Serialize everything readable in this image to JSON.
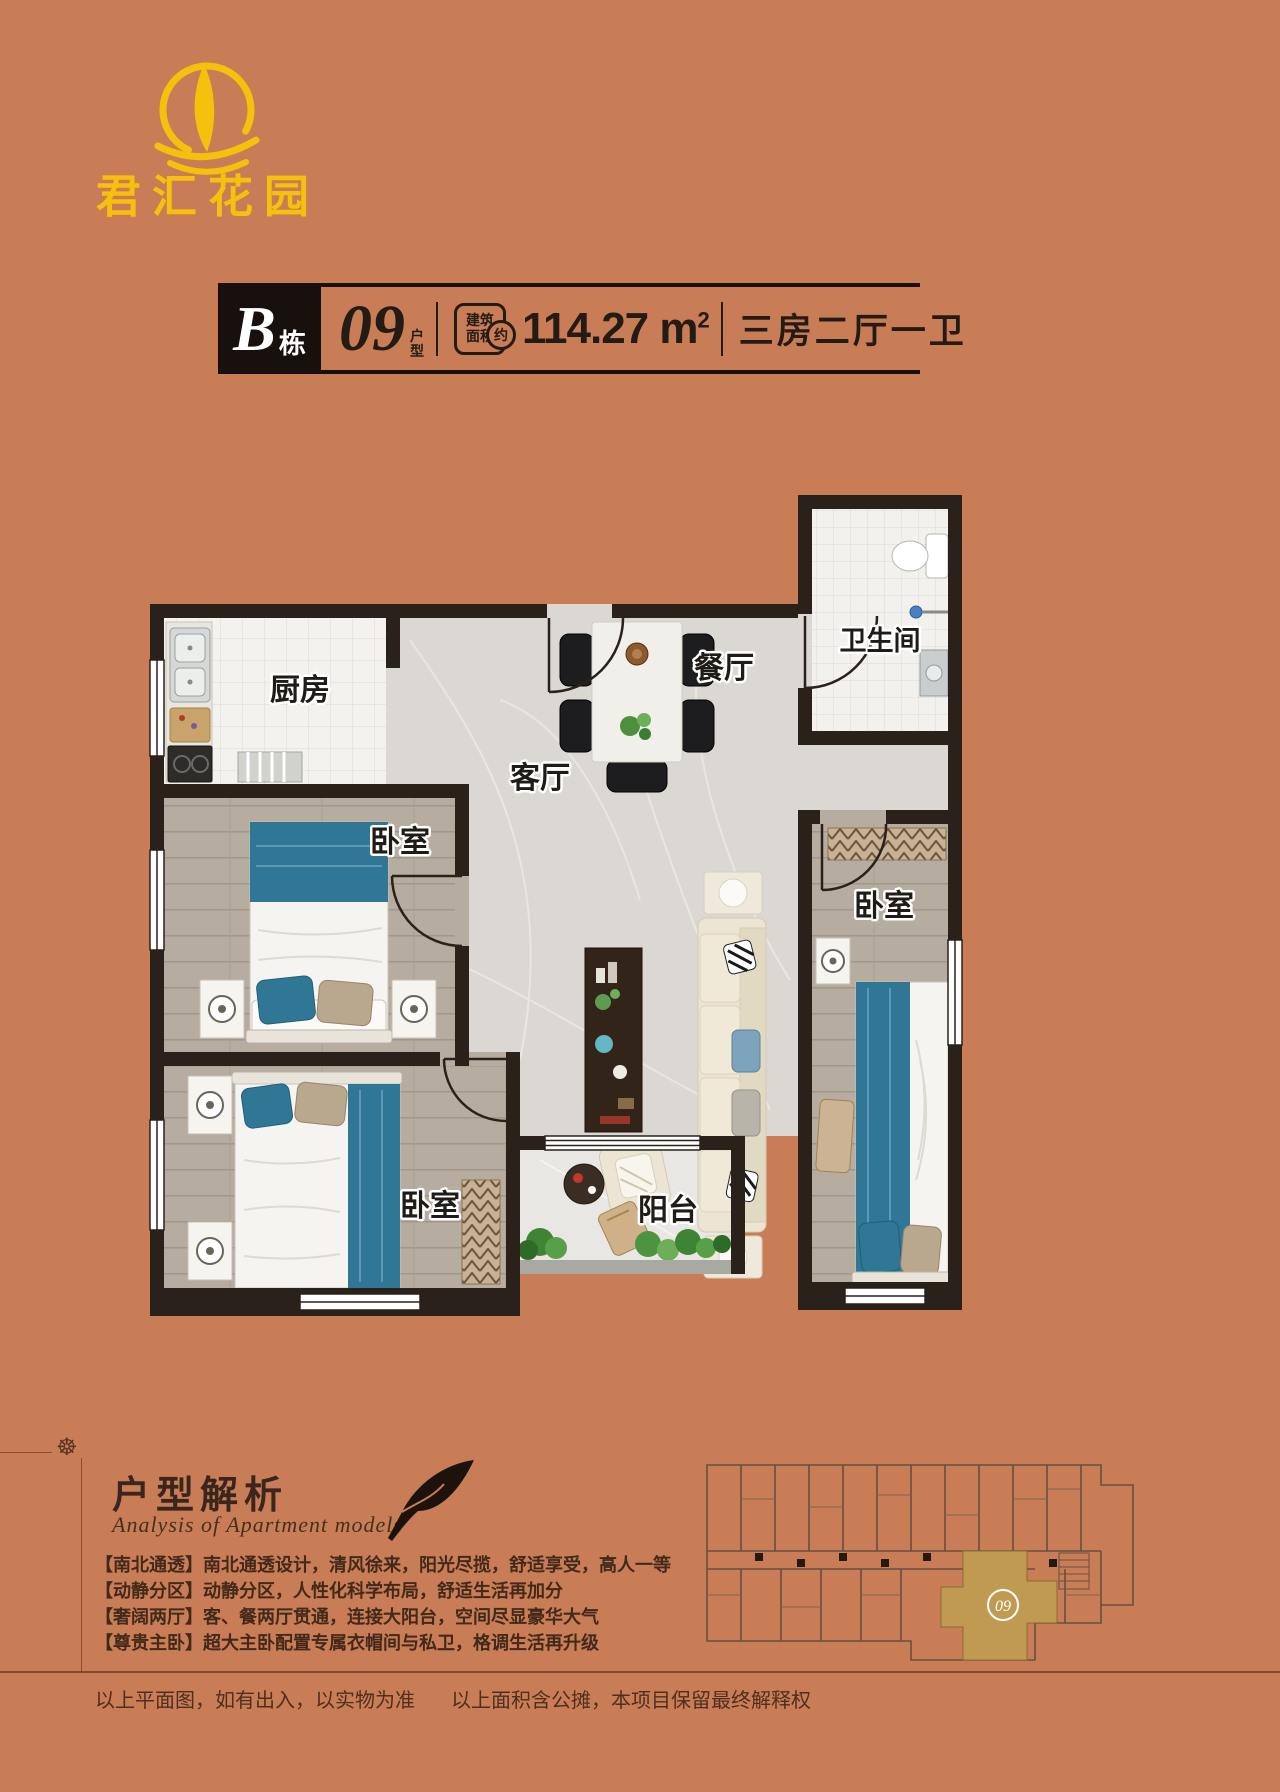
{
  "page": {
    "background": "#c97d57",
    "accent_gold": "#f6c10c",
    "wall_color": "#2b211b"
  },
  "logo": {
    "name": "君汇花园"
  },
  "title_bar": {
    "building_letter": "B",
    "building_suffix": "栋",
    "unit_number": "09",
    "unit_suffix": "户型",
    "badge_line1": "建筑",
    "badge_line2": "面积",
    "badge_approx": "约",
    "area_value": "114.27",
    "area_unit": "m",
    "area_sup": "2",
    "layout_text": "三房二厅一卫"
  },
  "floorplan": {
    "rooms": {
      "kitchen": "厨房",
      "dining": "餐厅",
      "bathroom": "卫生间",
      "living": "客厅",
      "bedroom_left": "卧室",
      "bedroom_bottom": "卧室",
      "bedroom_master": "卧室",
      "balcony": "阳台"
    }
  },
  "keyplan": {
    "unit_label": "09"
  },
  "analysis": {
    "title": "户型解析",
    "subtitle": "Analysis of Apartment models",
    "points": [
      "【南北通透】南北通透设计，清风徐来，阳光尽揽，舒适享受，高人一等",
      "【动静分区】动静分区，人性化科学布局，舒适生活再加分",
      "【奢阔两厅】客、餐两厅贯通，连接大阳台，空间尽显豪华大气",
      "【尊贵主卧】超大主卧配置专属衣帽间与私卫，格调生活再升级"
    ]
  },
  "footer": {
    "disclaimer_left": "以上平面图，如有出入，以实物为准",
    "disclaimer_right": "以上面积含公摊，本项目保留最终解释权"
  }
}
